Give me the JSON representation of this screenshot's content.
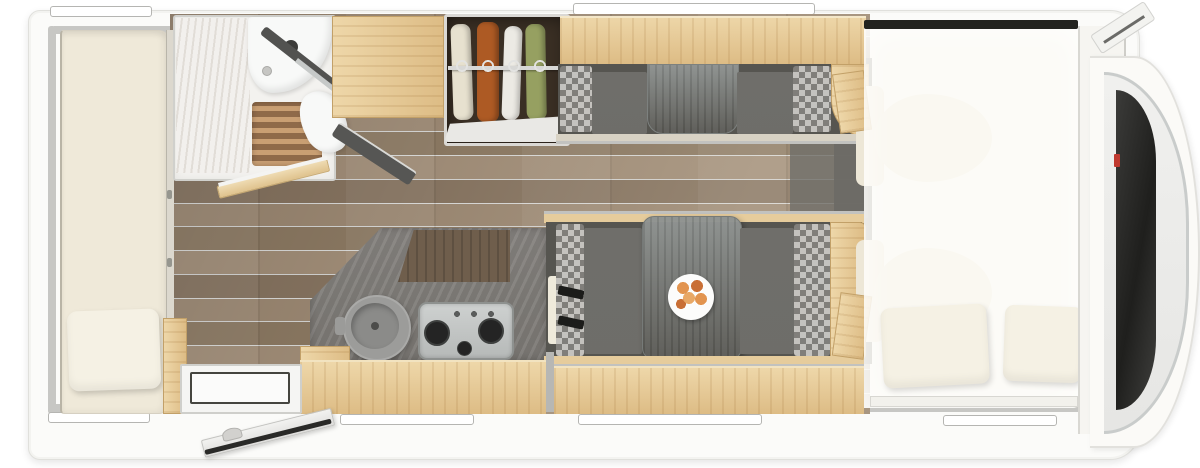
{
  "scene": {
    "type": "motorhome floor plan, top-down 3d render",
    "areas": [
      "rear-longitudinal-bed",
      "washroom-with-shower-basin-toilet",
      "wardrobe",
      "kitchen-with-sink-and-3-burner-hob",
      "face-to-face-dinette-with-table",
      "overcab-drop-down-bed",
      "driver-cab-with-two-seats",
      "entrance-door-open"
    ]
  },
  "counts": {
    "wardrobe_garments": 4,
    "hob_burners": 3,
    "dinette_benches": 2,
    "overcab_pillows": 2,
    "windows": 6
  },
  "colors": {
    "canvas": "#ffffff",
    "body": "#fbfbf9",
    "body_edge": "#e0e0dc",
    "wall": "#c7c7c4",
    "window_frame": "#b5b5b2",
    "floor_a": "#97846f",
    "floor_b": "#87755f",
    "floor_dark": "#5e5d58",
    "wood_hi": "#eed7a9",
    "wood": "#ddbc85",
    "wood_edge": "#c2a068",
    "mattress": "#efe9d9",
    "pillow": "#f5f1e4",
    "fixture": "#f8f9f8",
    "blind_a": "#f2f0ed",
    "blind_b": "#e1ddd7",
    "teak": "#8f6a49",
    "teak_stripe": "#c99f73",
    "partition_dark": "#525250",
    "wardrobe_box": "#3a2f24",
    "rail": "#d8d8d6",
    "garment1": "#e7e1cf",
    "garment2": "#ad5a24",
    "garment3": "#eceae4",
    "garment4": "#96a061",
    "bench_base": "#565550",
    "cushion": "#6f6e6a",
    "check_light": "#c4c2be",
    "check_dark": "#807e7a",
    "table": "#8b8f8d",
    "frame_wood": "#e6cc9c",
    "metal": "#c2c2bf",
    "counter": "#86837f",
    "counter_dark": "#6f5e4c",
    "sink": "#8b8b89",
    "hob_a": "#ced1d0",
    "hob_b": "#b6b9b8",
    "burner": "#242424",
    "plate": "#fcfcfb",
    "fruit_a": "#e2944f",
    "fruit_b": "#c96f35",
    "belt": "#1c1c1a",
    "overlay": "rgba(252,251,246,0.80)",
    "bed_bar": "#23231f",
    "seat_cream": "#ede7d7",
    "pillar": "#f6f5f1",
    "chrome": "#c9cccb",
    "glass": "#2b2b29",
    "accent_red": "#c0392f",
    "step": "#f5f5f3",
    "door_seal": "#2a2a28"
  }
}
